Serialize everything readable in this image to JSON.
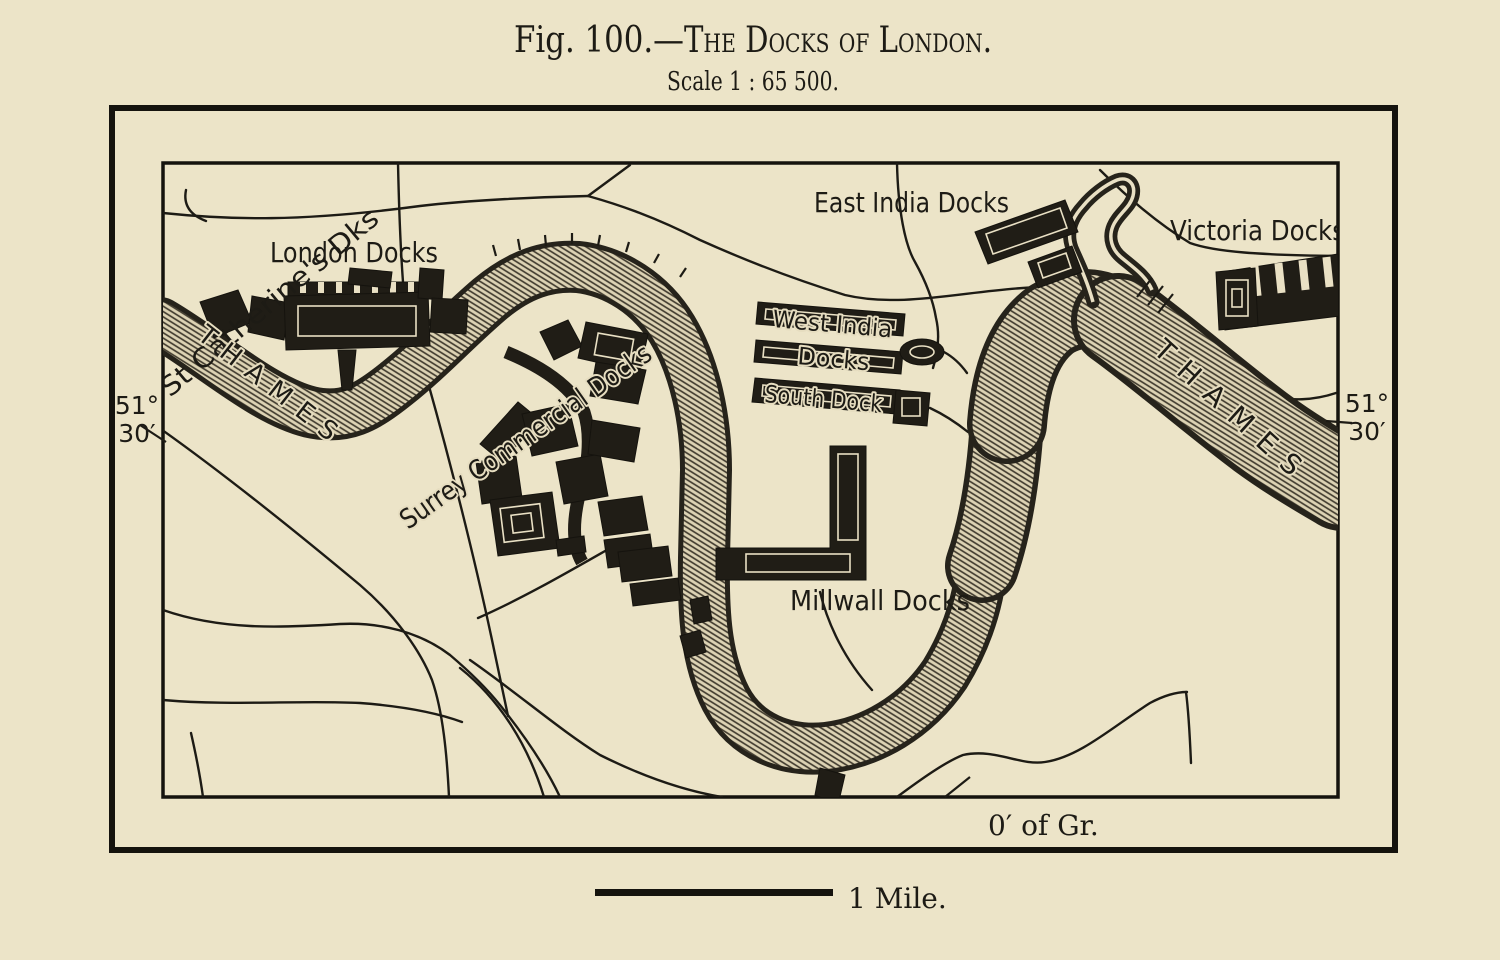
{
  "figure": {
    "title_prefix": "Fig. 100.—",
    "title_main": "The Docks of London.",
    "subtitle": "Scale 1 : 65 500."
  },
  "map": {
    "labels": {
      "st_catherines": "St Catherine's Dks",
      "london_docks": "London Docks",
      "east_india_docks": "East India Docks",
      "victoria_docks": "Victoria Docks",
      "west_india_line1": "West India",
      "west_india_line2": "Docks",
      "south_dock": "South Dock",
      "surrey_commercial": "Surrey Commercial Docks",
      "millwall_docks": "Millwall Docks",
      "thames_west": "THAMES",
      "thames_east": "THAMES"
    },
    "coordinates": {
      "lat_left_deg": "51°",
      "lat_left_min": "30′",
      "lat_right_deg": "51°",
      "lat_right_min": "30′",
      "meridian": "0′ of Gr."
    }
  },
  "scale_bar": {
    "label": "1 Mile."
  },
  "colors": {
    "paper": "#ece4c8",
    "ink": "#1d1b15",
    "river_dark": "#26231b",
    "detail_cream": "#e9e0c4"
  }
}
